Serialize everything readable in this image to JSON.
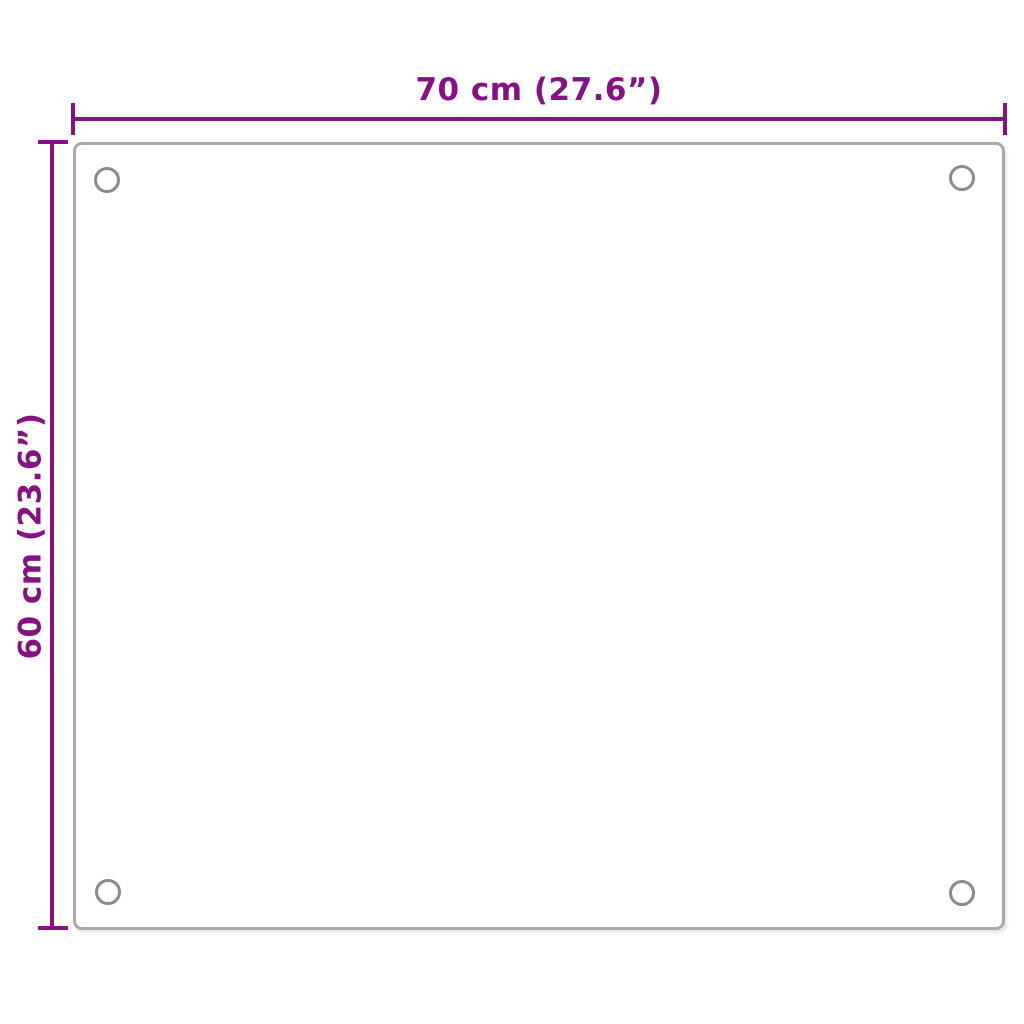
{
  "title": "Panel dimension diagram",
  "colors": {
    "background": "#ffffff",
    "dimension": "#861184",
    "panel_border": "#a9a9a9",
    "hole_border": "#8a8a8a"
  },
  "dimensions": {
    "width": {
      "label": "70 cm (27.6”)"
    },
    "height": {
      "label": "60 cm (23.6”)"
    }
  },
  "panel": {
    "mounting_holes": 4
  }
}
